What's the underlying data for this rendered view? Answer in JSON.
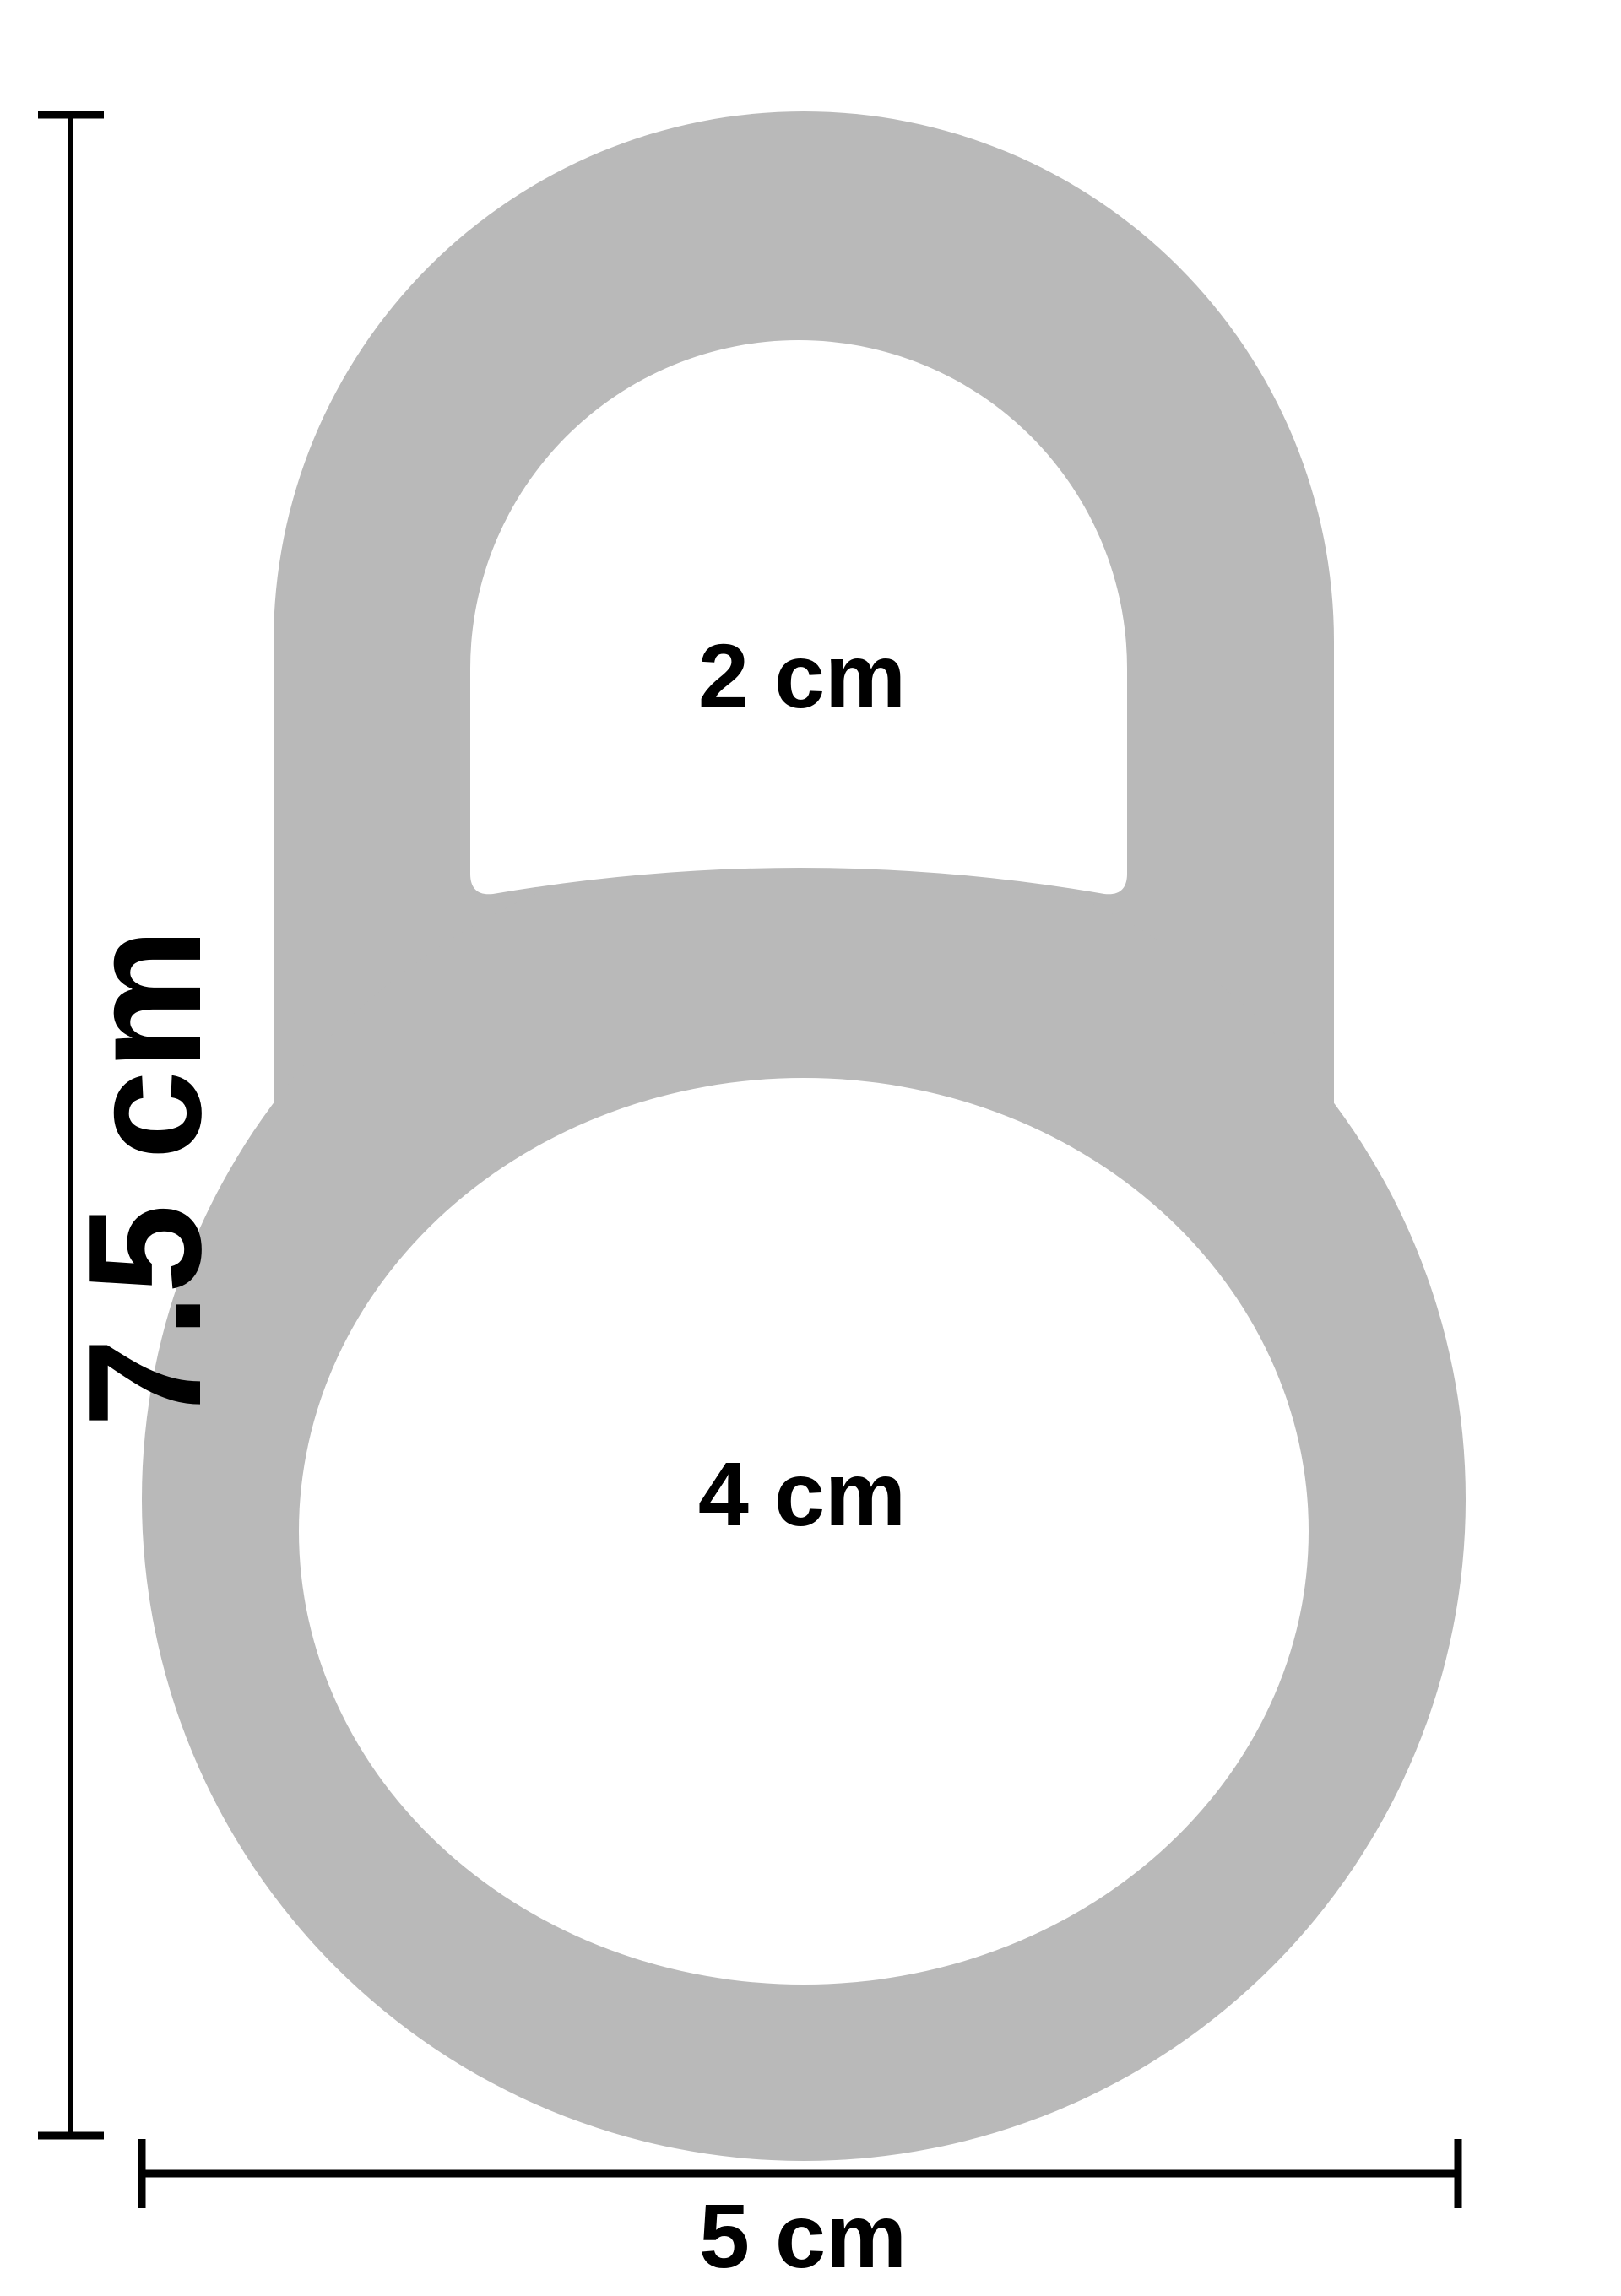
{
  "figure": {
    "type": "product-dimension-diagram",
    "description": "Gray pull-tab shaped ring with two holes and dimension annotations",
    "labels": {
      "upper_hole": "2 cm",
      "lower_hole": "4 cm",
      "total_height": "7.5 cm",
      "total_width": "5 cm"
    },
    "colors": {
      "shape_fill": "#b9b9b9",
      "hole_fill": "#ffffff",
      "dimension_line": "#000000",
      "background": "#ffffff"
    }
  }
}
